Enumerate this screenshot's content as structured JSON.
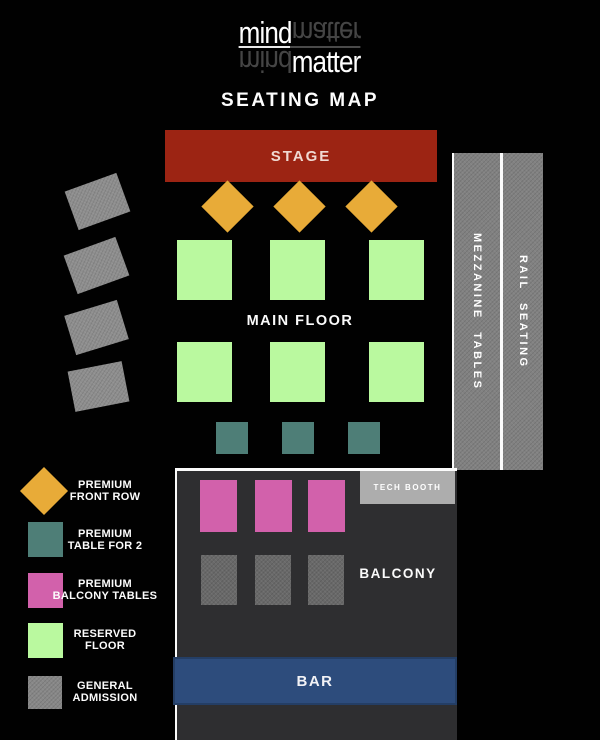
{
  "brand": {
    "word_top": "mind",
    "word_bottom": "matter"
  },
  "title": "SEATING MAP",
  "stage": {
    "label": "STAGE"
  },
  "main_floor": {
    "label": "MAIN FLOOR"
  },
  "mezzanine": {
    "label": "MEZZANINE TABLES"
  },
  "rail_seating": {
    "label": "RAIL SEATING"
  },
  "balcony": {
    "label": "BALCONY"
  },
  "tech_booth": {
    "label": "TECH BOOTH"
  },
  "bar": {
    "label": "BAR"
  },
  "legend": {
    "items": [
      {
        "swatch": "gold-diamond",
        "color": "#e8ab38",
        "line1": "PREMIUM",
        "line2": "FRONT ROW"
      },
      {
        "swatch": "teal-square",
        "color": "#4e7e77",
        "line1": "PREMIUM",
        "line2": "TABLE FOR 2"
      },
      {
        "swatch": "pink-square",
        "color": "#d261ab",
        "line1": "PREMIUM",
        "line2": "BALCONY TABLES"
      },
      {
        "swatch": "green-square",
        "color": "#baf99f",
        "line1": "RESERVED",
        "line2": "FLOOR"
      },
      {
        "swatch": "gray-square",
        "color": "#878787",
        "line1": "GENERAL",
        "line2": "ADMISSION"
      }
    ]
  },
  "seating_counts": {
    "premium_front_row": 3,
    "reserved_floor": 6,
    "premium_table_for_2": 3,
    "premium_balcony_tables": 3,
    "balcony_general_admission": 3,
    "side_general_admission": 4
  },
  "colors": {
    "background": "#010101",
    "stage_red": "#9c2413",
    "premium_front_row_gold": "#e8ab38",
    "premium_table_teal": "#4e7e77",
    "premium_balcony_pink": "#d261ab",
    "reserved_floor_green": "#baf99f",
    "general_admission_gray": "#8e8e8e",
    "mezzanine_gray": "#818181",
    "balcony_panel": "#2e2e30",
    "balcony_seat_gray": "#696969",
    "tech_booth_gray": "#adadad",
    "bar_blue": "#2d4c7c"
  }
}
